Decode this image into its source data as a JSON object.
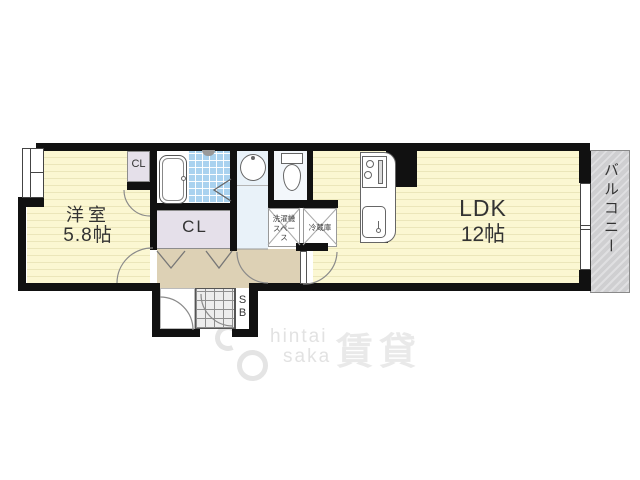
{
  "plan": {
    "rooms": {
      "western": {
        "name": "洋室",
        "size": "5.8帖"
      },
      "ldk": {
        "name": "LDK",
        "size": "12帖"
      },
      "balcony": {
        "label": "バルコニー"
      }
    },
    "closets": {
      "small_closet": "CL",
      "main_closet": "CL",
      "shoe_box": "SB"
    },
    "utility": {
      "washing_machine": "洗濯機スペース",
      "refrigerator": "冷蔵庫"
    }
  },
  "watermark": {
    "text_top": "hintai",
    "text_bottom": "saka",
    "kanji": "賃貸"
  },
  "colors": {
    "floor_cream": "#fbf7d2",
    "hall_beige": "#ddd1b5",
    "closet_lavender": "#e5e0ea",
    "tile_blue": "#a9d2ef",
    "balcony_gray": "#d2d2d4",
    "wall": "#111111"
  }
}
